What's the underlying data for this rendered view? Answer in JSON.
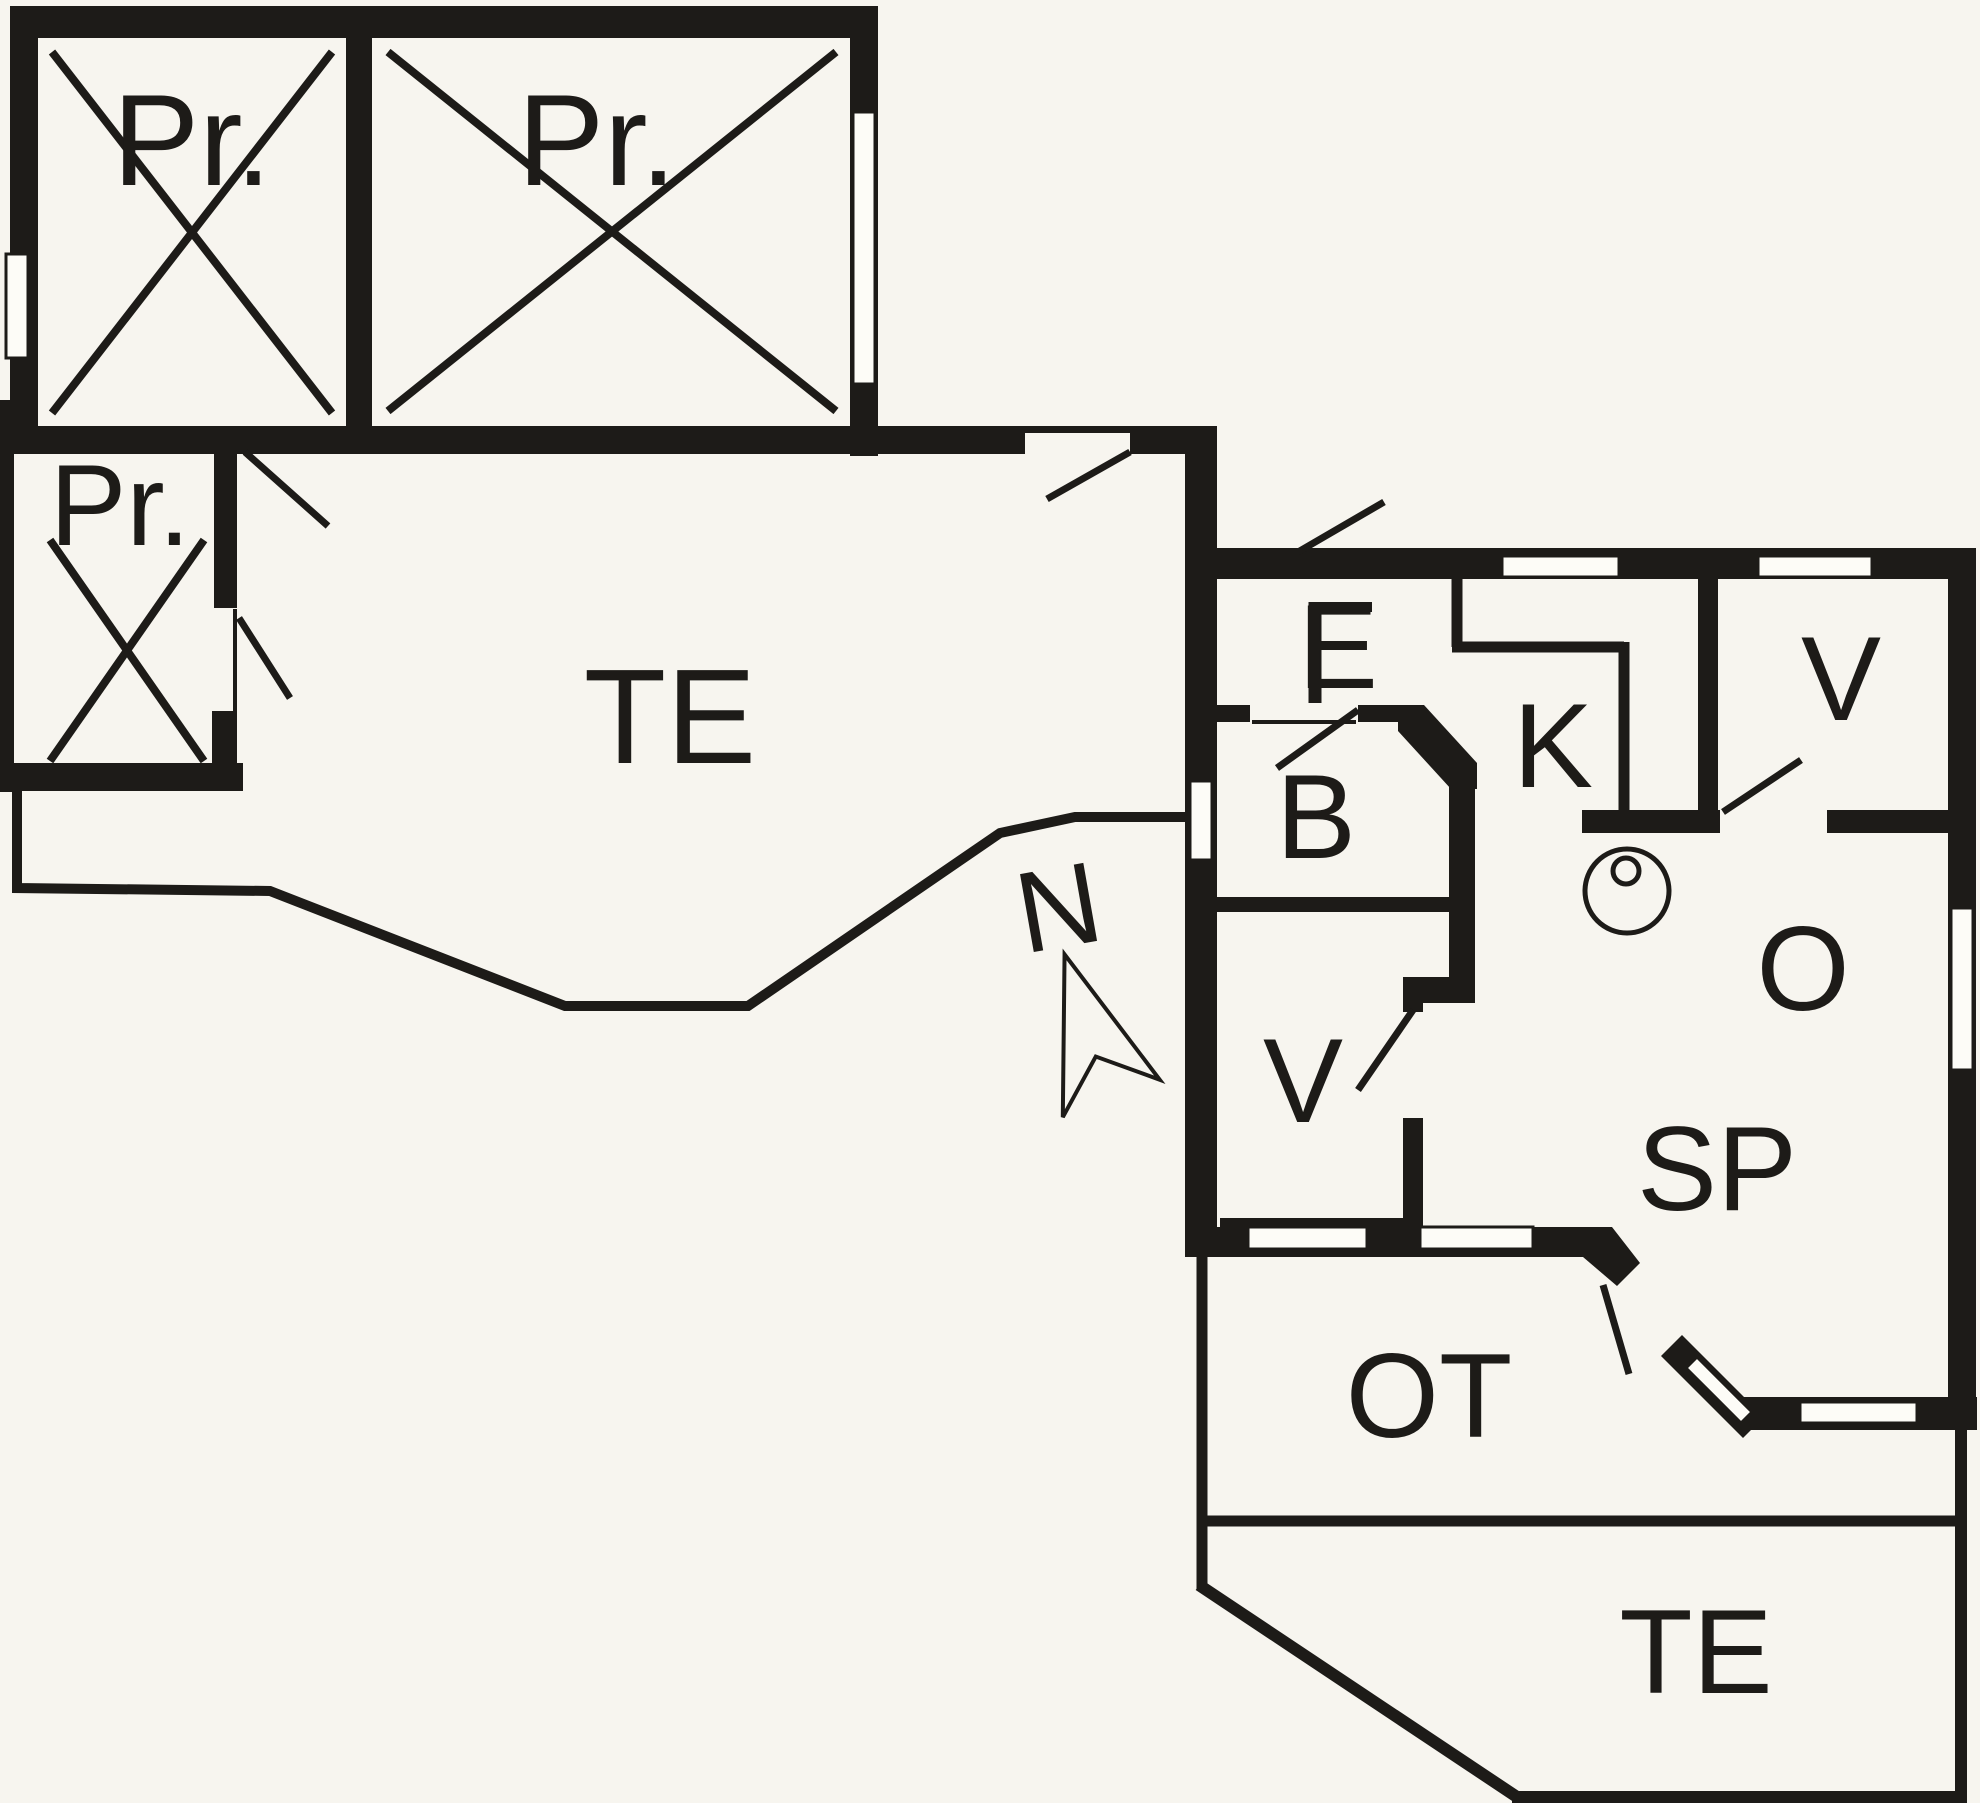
{
  "document": {
    "type": "floor-plan",
    "style": "architectural black-line drawing"
  },
  "colors": {
    "ink": "#1d1b18",
    "paper": "#f7f5ef",
    "window": "#fdfcf7"
  },
  "rooms": {
    "pr_shed_1": {
      "label": "Pr."
    },
    "pr_shed_2": {
      "label": "Pr."
    },
    "pr_shed_3": {
      "label": "Pr."
    },
    "terrace_main": {
      "label": "TE"
    },
    "entrance": {
      "label": "E"
    },
    "bathroom": {
      "label": "B"
    },
    "kitchen": {
      "label": "K"
    },
    "bedroom_north": {
      "label": "V"
    },
    "bedroom_west": {
      "label": "V"
    },
    "living_room": {
      "label": "O"
    },
    "dining": {
      "label": "SP"
    },
    "covered_terrace": {
      "label": "OT"
    },
    "terrace_south": {
      "label": "TE"
    }
  },
  "compass": {
    "label": "N"
  }
}
